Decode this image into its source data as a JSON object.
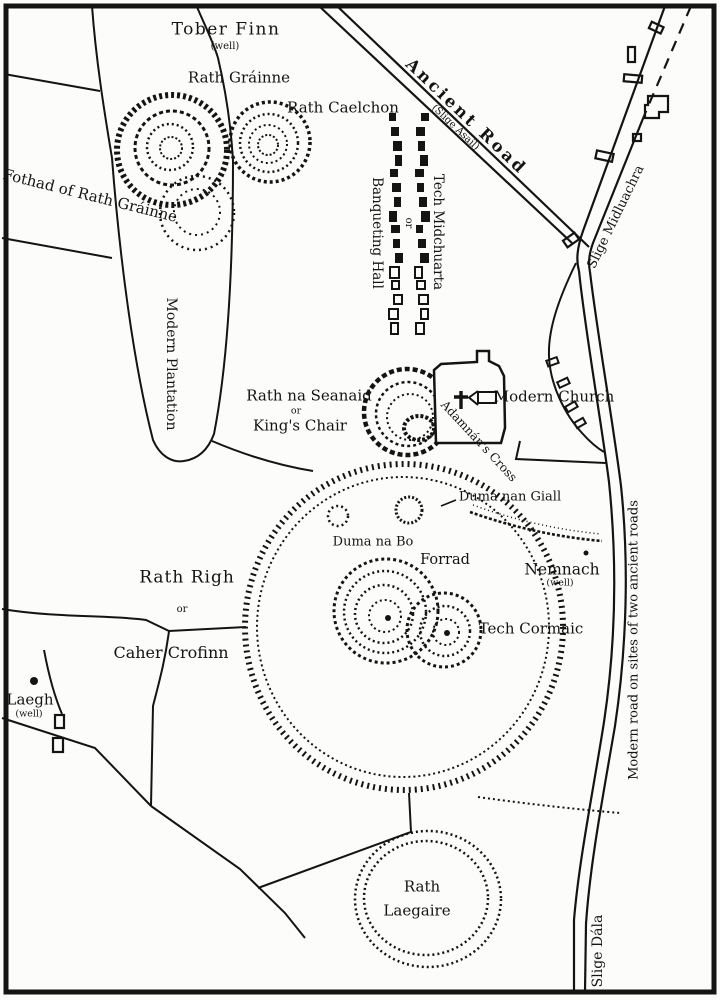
{
  "map": {
    "labels": {
      "tober_finn": "Tober Finn",
      "tober_finn_note": "(well)",
      "rath_grainne": "Rath Gráinne",
      "rath_caelchon": "Rath Caelchon",
      "ancient_road": "Ancient Road",
      "ancient_road_note": "(Slige Asail)",
      "fothad": "Fothad of Rath Gráinne",
      "banqueting_hall_irish": "Tech Midchuarta",
      "banqueting_hall_or": "or",
      "banqueting_hall": "Banqueting Hall",
      "slige_midluachra": "Slige Midluachra",
      "modern_plantation": "Modern Plantation",
      "rath_na_seanaid": "Rath na Seanaid",
      "rath_na_seanaid_or": "or",
      "kings_chair": "King's Chair",
      "adamnans_cross": "Adamnán's Cross",
      "modern_church": "Modern Church",
      "duma_nan_giall": "Duma nan Giall",
      "duma_na_bo": "Duma na Bo",
      "forrad": "Forrad",
      "nemnach": "Nemnach",
      "nemnach_note": "(well)",
      "tech_cormaic": "Tech Cormaic",
      "rath_righ": "Rath Righ",
      "rath_righ_or": "or",
      "caher_crofinn": "Caher Crofinn",
      "laegh": "Laegh",
      "laegh_note": "(well)",
      "modern_road": "Modern road on sites of two ancient roads",
      "rath_laegaire_1": "Rath",
      "rath_laegaire_2": "Laegaire",
      "slige_dala": "Slige Dála"
    },
    "colors": {
      "ink": "#141414",
      "paper": "#fcfcfa"
    }
  }
}
